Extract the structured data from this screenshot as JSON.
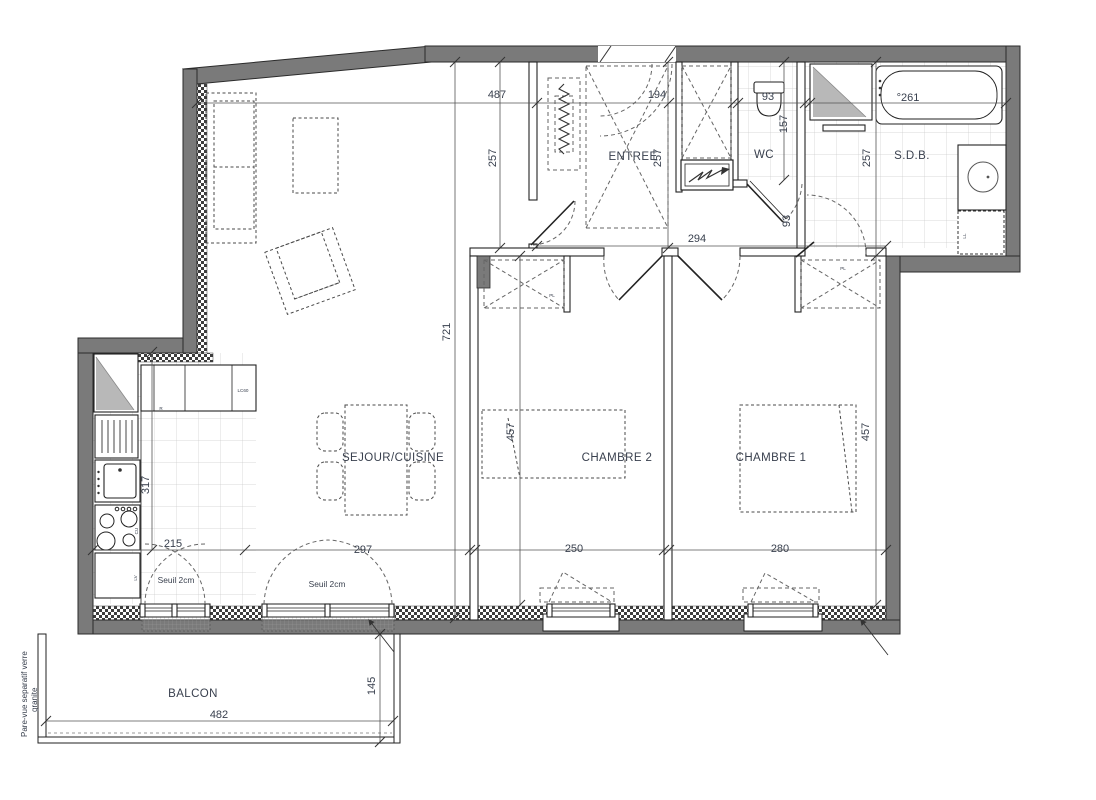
{
  "colors": {
    "wall": "#7a7a7a",
    "wall_edge": "#2b2b2b",
    "line": "#222222",
    "dash": "#666666",
    "text": "#39404e",
    "tile_line": "#cccccc",
    "shaft_gray": "#b8b8b8",
    "checker": "#3d3d3d"
  },
  "rooms": {
    "entree": "ENTREE",
    "wc": "WC",
    "sdb": "S.D.B.",
    "sejour": "SEJOUR/CUISINE",
    "chambre2": "CHAMBRE 2",
    "chambre1": "CHAMBRE 1",
    "balcon": "BALCON"
  },
  "dimensions": {
    "sejour_top": "487",
    "entree_top": "194",
    "wc_top": "93",
    "bath_length": "°261",
    "sejour_depth_right": "257",
    "entree_depth": "257",
    "sdb_depth": "257",
    "wc_depth": "157",
    "wc_door": "93",
    "hallway": "294",
    "sejour_depth": "721",
    "chambre2_depth": "457",
    "chambre1_depth": "457",
    "kitchen_depth": "317",
    "kitchen_width": "215",
    "sejour_width": "297",
    "chambre2_width": "250",
    "chambre1_width": "280",
    "balcon_width": "482",
    "balcon_depth": "145"
  },
  "annotations": {
    "seuil_kitchen": "Seuil 2cm",
    "seuil_sejour": "Seuil 2cm",
    "parevue_line1": "Pare-vue separatif verre",
    "parevue_line2": "granite"
  },
  "equipment": {
    "fridge": "R",
    "washer_column": "LC60",
    "dishwasher": "LV",
    "cooktop": "CU",
    "washing_machine": "LL",
    "placard2": "PL",
    "placard1": "PL"
  }
}
